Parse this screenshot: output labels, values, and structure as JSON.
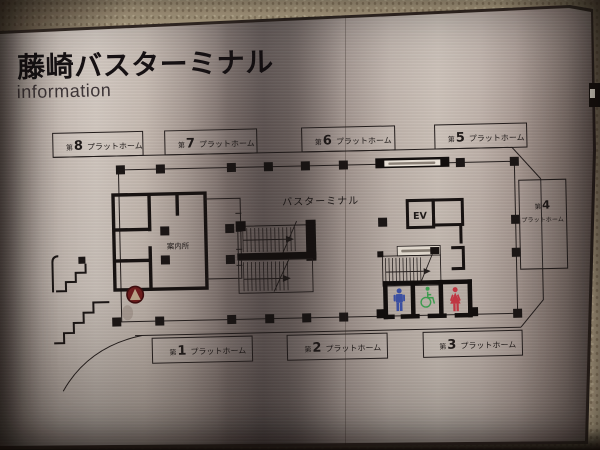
{
  "sign": {
    "title": "藤崎バスターミナル",
    "subtitle": "information"
  },
  "map": {
    "terminal_label": "バスターミナル",
    "info_office": "案内所",
    "elevator": "EV",
    "platform_prefix": "第",
    "platform_word": "プラットホーム",
    "platforms_top": [
      {
        "num": "8"
      },
      {
        "num": "7"
      },
      {
        "num": "6"
      },
      {
        "num": "5"
      }
    ],
    "platforms_bottom": [
      {
        "num": "1"
      },
      {
        "num": "2"
      },
      {
        "num": "3"
      }
    ],
    "platform_right": {
      "num": "4"
    },
    "icons": {
      "male_color": "#3b4fa0",
      "female_color": "#bf3642",
      "accessible_color": "#3e9b4f",
      "marker_color": "#6b1c1c",
      "marker_arrow_color": "#b7a286",
      "ink_color": "#241e1d"
    }
  }
}
